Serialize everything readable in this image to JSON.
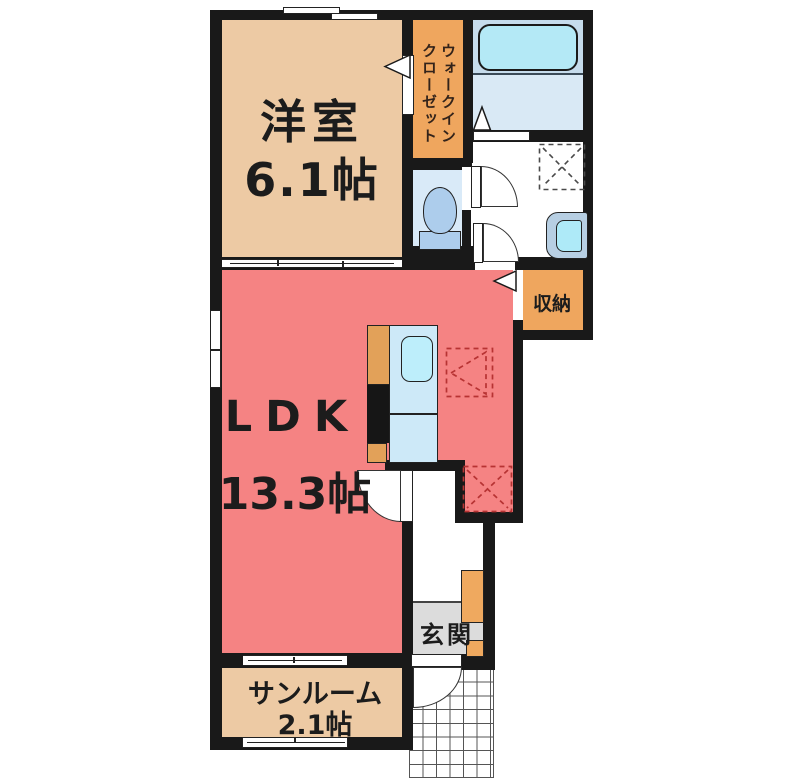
{
  "rooms": {
    "yoshitsu": {
      "name": "洋室",
      "size": "6.1帖"
    },
    "wic": {
      "line1": "ウォークイン",
      "line2": "クローゼット"
    },
    "ldk": {
      "name": "LDK",
      "size": "13.3帖"
    },
    "sunroom": {
      "name": "サンルーム",
      "size": "2.1帖"
    },
    "genkan": {
      "name": "玄関"
    },
    "storage": {
      "name": "収納"
    }
  },
  "colors": {
    "wall": "#191919",
    "room_beige": "#edcaa4",
    "room_red": "#f58383",
    "closet_orange": "#efa65e",
    "bath_floor_blue": "#d9e9f5",
    "bath_upper_blue": "#c6dcec",
    "toilet_room_blue": "#d9eaf8",
    "fixture_blue": "#bdeefb",
    "tub_blue": "#b4e9f6",
    "genkan_gray": "#dcdcdc",
    "dashed_red": "#b73333",
    "dashed_gray": "#4a4a4a"
  },
  "fixtures": {
    "bathtub": "bathtub",
    "washbasin": "wash-basin",
    "toilet": "toilet",
    "kitchen_counter": "kitchen-counter",
    "kitchen_sink": "kitchen-sink",
    "refrigerator_space": "refrigerator-space",
    "washer_space": "washing-machine-space",
    "shoe_cabinet": "shoe-cabinet",
    "entrance_porch": "entrance-porch"
  }
}
